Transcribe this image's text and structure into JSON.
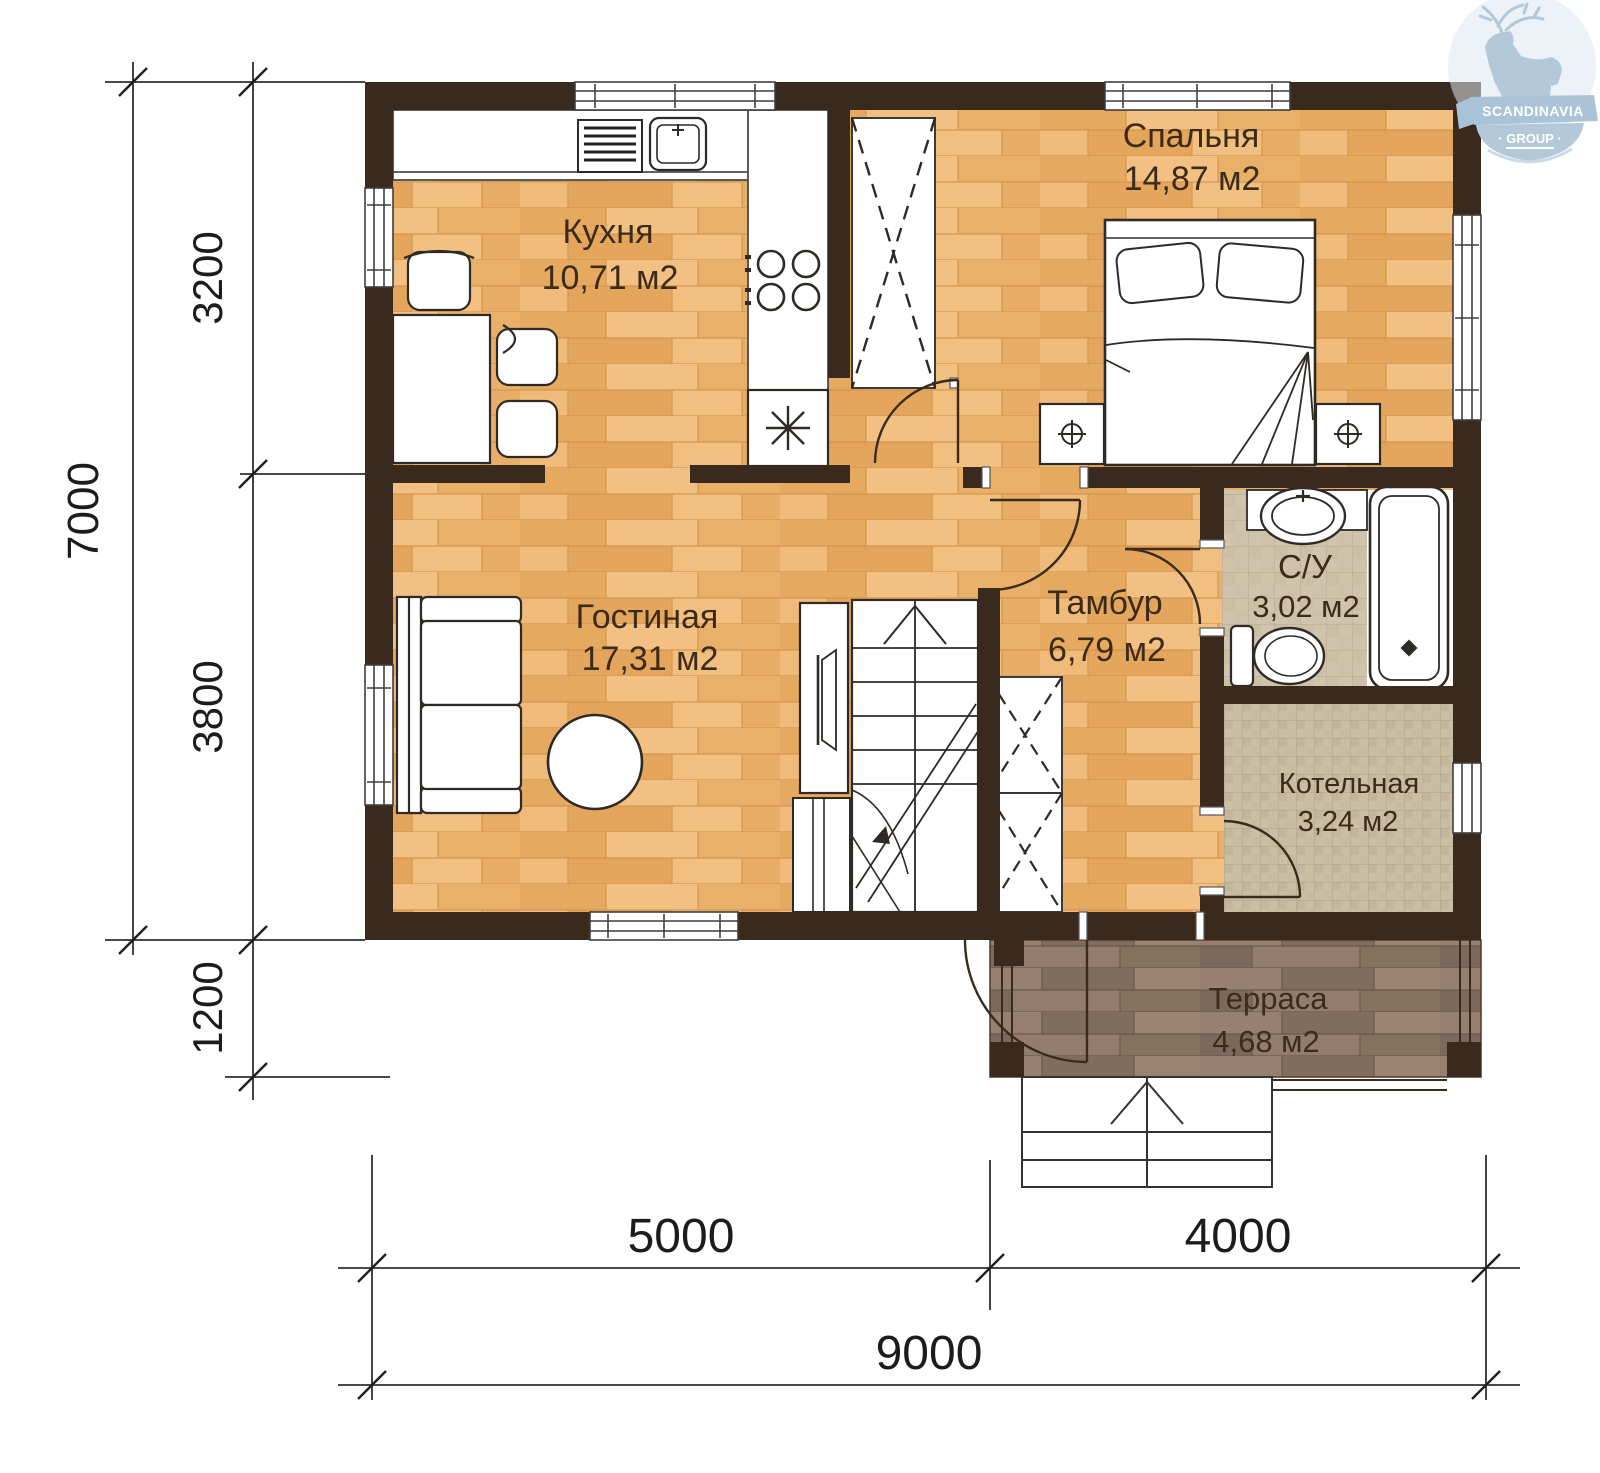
{
  "logo": {
    "line1": "SCANDINAVIA",
    "line2": "· GROUP ·"
  },
  "rooms": {
    "kitchen": {
      "name": "Кухня",
      "area": "10,71 м2"
    },
    "bedroom": {
      "name": "Спальня",
      "area": "14,87 м2"
    },
    "living": {
      "name": "Гостиная",
      "area": "17,31 м2"
    },
    "tambour": {
      "name": "Тамбур",
      "area": "6,79 м2"
    },
    "bathroom": {
      "name": "С/У",
      "area": "3,02 м2"
    },
    "boiler": {
      "name": "Котельная",
      "area": "3,24 м2"
    },
    "terrace": {
      "name": "Терраса",
      "area": "4,68 м2"
    }
  },
  "dimensions": {
    "left": {
      "total": "7000",
      "top": "3200",
      "middle": "3800",
      "bottom": "1200"
    },
    "bottom": {
      "left": "5000",
      "right": "4000",
      "total": "9000"
    }
  },
  "colors": {
    "wall": "#3a2a1e",
    "wood": "#ecb470",
    "terrace_wood": "#8d7668",
    "tile": "#d0c4ac",
    "logo_blue": "#b3c9da"
  }
}
